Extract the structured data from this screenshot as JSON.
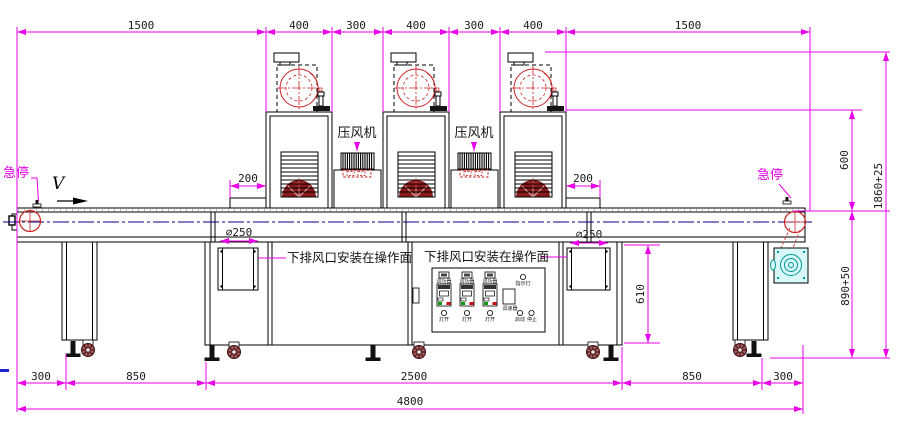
{
  "labels": {
    "estop": "急停",
    "direction": "V",
    "blower": "压风机",
    "duct_note": "下排风口安装在操作面",
    "dia": "∅250"
  },
  "dims": {
    "top": [
      "1500",
      "400",
      "300",
      "400",
      "300",
      "400",
      "1500"
    ],
    "entry": [
      "200",
      "200"
    ],
    "right": [
      "600",
      "1860+25",
      "890+50"
    ],
    "cabinet": "610",
    "bottom": [
      "300",
      "850",
      "2500",
      "850",
      "300"
    ],
    "total": "4800"
  },
  "panel": {
    "regulators": [
      "调功器",
      "调功器",
      "调功器"
    ],
    "lamp_switches": [
      "灯开",
      "灯开",
      "灯开"
    ],
    "indicator": "指示灯",
    "speed": "调速器",
    "start": "启动",
    "stop": "停止"
  },
  "colors": {
    "dimension": "#e800e8",
    "line": "#000000",
    "centerline": "#000080",
    "fan_red": "#cc2222",
    "fan_dark": "#8b1a1a",
    "motor_cyan": "#009999"
  }
}
